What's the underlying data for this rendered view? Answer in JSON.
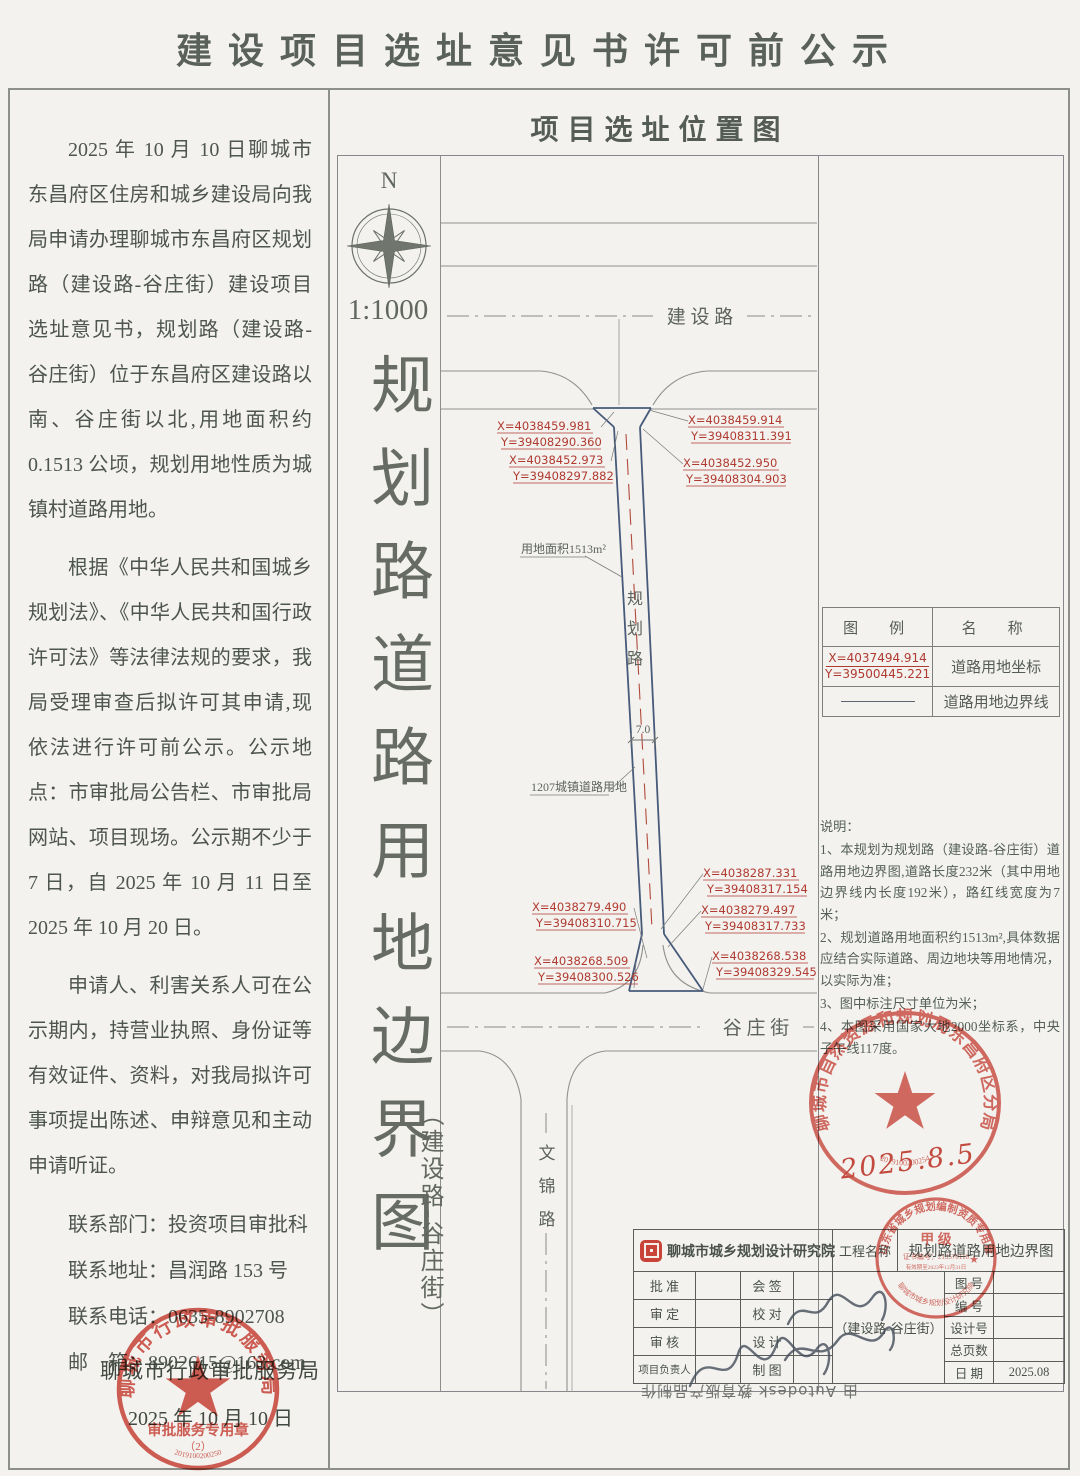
{
  "title": "建设项目选址意见书许可前公示",
  "left": {
    "para1": "2025 年 10 月 10 日聊城市东昌府区住房和城乡建设局向我局申请办理聊城市东昌府区规划路（建设路-谷庄街）建设项目选址意见书，规划路（建设路-谷庄街）位于东昌府区建设路以南、谷庄街以北,用地面积约 0.1513 公顷，规划用地性质为城镇村道路用地。",
    "para2": "根据《中华人民共和国城乡规划法》、《中华人民共和国行政许可法》等法律法规的要求，我局受理审查后拟许可其申请,现依法进行许可前公示。公示地点：市审批局公告栏、市审批局网站、项目现场。公示期不少于 7 日，自 2025 年 10 月 11 日至 2025 年 10 月 20 日。",
    "para3": "申请人、利害关系人可在公示期内，持营业执照、身份证等有效证件、资料，对我局拟许可事项提出陈述、申辩意见和主动申请听证。",
    "contacts": [
      "联系部门：投资项目审批科",
      "联系地址：昌润路 153 号",
      "联系电话：0635-8902708",
      "邮　箱：8902615@163.com"
    ],
    "issuer": "聊城市行政审批服务局",
    "date": "2025 年 10 月 10 日"
  },
  "map": {
    "title": "项目选址位置图",
    "compass_n": "N",
    "scale": "1:1000",
    "side_title": "规划路道路用地边界图",
    "side_sub": "（建设路-谷庄街）",
    "road_north": "建 设 路",
    "road_south": "谷 庄 街",
    "road_west_chars": [
      "文",
      "锦",
      "路"
    ],
    "planned_chars": [
      "规",
      "划",
      "路"
    ],
    "area_label": "用地面积1513m²",
    "width_dim": "7.0",
    "land_use_label": "1207城镇道路用地",
    "coords": [
      {
        "x": "X=4038459.981",
        "y": "Y=39408290.360"
      },
      {
        "x": "X=4038459.914",
        "y": "Y=39408311.391"
      },
      {
        "x": "X=4038452.973",
        "y": "Y=39408297.882"
      },
      {
        "x": "X=4038452.950",
        "y": "Y=39408304.903"
      },
      {
        "x": "X=4038287.331",
        "y": "Y=39408317.154"
      },
      {
        "x": "X=4038279.490",
        "y": "Y=39408310.715"
      },
      {
        "x": "X=4038279.497",
        "y": "Y=39408317.733"
      },
      {
        "x": "X=4038268.509",
        "y": "Y=39408300.526"
      },
      {
        "x": "X=4038268.538",
        "y": "Y=39408329.545"
      }
    ],
    "legend": {
      "h1": "图　例",
      "h2": "名　称",
      "coord_x": "X=4037494.914",
      "coord_y": "Y=39500445.221",
      "r1": "道路用地坐标",
      "r2": "道路用地边界线"
    },
    "notes_title": "说明：",
    "notes": [
      "1、本规划为规划路（建设路-谷庄街）道路用地边界图,道路长度232米（其中用地边界线内长度192米），路红线宽度为7米；",
      "2、规划道路用地面积约1513m²,具体数据应结合实际道路、周边地块等用地情况，以实际为准；",
      "3、图中标注尺寸单位为米；",
      "4、本图采用国家大地2000坐标系，中央子午线117度。"
    ],
    "watermark": "由 Autodesk 教育版产品制作"
  },
  "titleblock": {
    "company": "聊城市城乡规划设计研究院",
    "project_label": "工程名称",
    "project_name": "规划路道路用地边界图",
    "project_sub": "（建设路-谷庄街）",
    "rows": [
      {
        "l1": "批 准",
        "l2": "会 签"
      },
      {
        "l1": "审 定",
        "l2": "校 对"
      },
      {
        "l1": "审 核",
        "l2": "设 计"
      },
      {
        "l1": "项目负责人",
        "l2": "制 图"
      }
    ],
    "right_rows": [
      "图 号",
      "编 号",
      "设计号",
      "总页数"
    ],
    "date_label": "日 期",
    "date_value": "2025.08"
  },
  "stamps": {
    "resources": {
      "ring": "聊城市自然资源和规划局东昌府区分局",
      "serial": "2019100200254",
      "note": "2025.8.5"
    },
    "cert": {
      "ring": "山东省城乡规划编制资质专用章",
      "level": "甲 级",
      "cert_no": "证书编号：213570110",
      "validity": "有效期至2023年12月31日",
      "org": "聊城市城乡规划设计研究院",
      "star": "★"
    },
    "approval": {
      "ring": "聊城市行政审批服务局",
      "line1": "审批服务专用章",
      "line2": "（2）",
      "serial": "2019100200250"
    }
  },
  "colors": {
    "stamp_red": "#d14b40",
    "coord_red": "#b03a30",
    "boundary_navy": "#475a7a",
    "line_gray": "#8f918f"
  }
}
